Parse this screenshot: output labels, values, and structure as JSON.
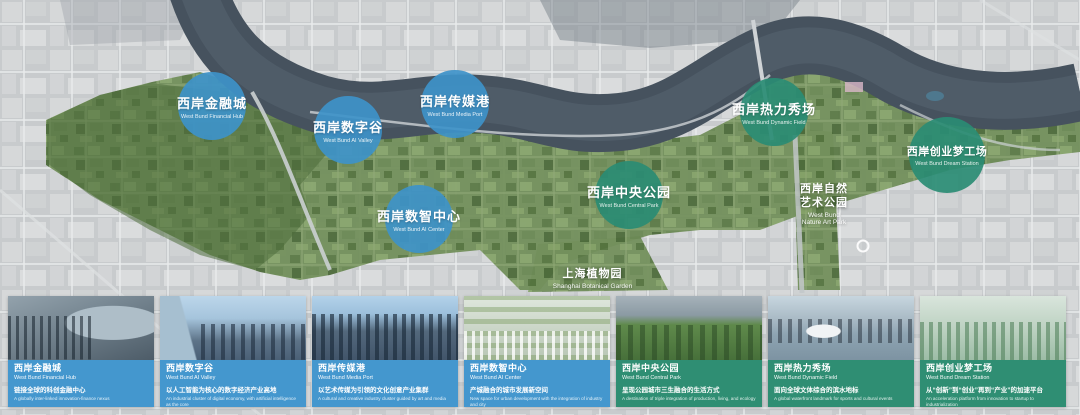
{
  "colors": {
    "zone_blue": "#3e92c9",
    "zone_green": "#2a8c74",
    "panel_blue": "#4497ce",
    "panel_green": "#2f8e73",
    "river": "#46525e",
    "map_grey": "#c6c9cb",
    "green_corridor": "#73905c"
  },
  "map": {
    "zones": [
      {
        "id": "financial-hub",
        "title_zh": "西岸金融城",
        "title_en": "West Bund Financial Hub"
      },
      {
        "id": "digital-valley",
        "title_zh": "西岸数字谷",
        "title_en": "West Bund AI Valley"
      },
      {
        "id": "media-port",
        "title_zh": "西岸传媒港",
        "title_en": "West Bund Media Port"
      },
      {
        "id": "ai-center",
        "title_zh": "西岸数智中心",
        "title_en": "West Bund AI Center"
      },
      {
        "id": "central-park",
        "title_zh": "西岸中央公园",
        "title_en": "West Bund Central Park"
      },
      {
        "id": "dynamic-field",
        "title_zh": "西岸热力秀场",
        "title_en": "West Bund Dynamic Field"
      },
      {
        "id": "dream-station",
        "title_zh": "西岸创业梦工场",
        "title_en": "West Bund Dream Station"
      }
    ],
    "labels": {
      "nature_art_park": {
        "zh1": "西岸自然",
        "zh2": "艺术公园",
        "en1": "West Bund",
        "en2": "Nature Art Park"
      },
      "botanical_garden": {
        "zh": "上海植物园",
        "en": "Shanghai Botanical Garden"
      }
    }
  },
  "cards": [
    {
      "title_zh": "西岸金融城",
      "title_en": "West Bund Financial Hub",
      "desc_zh": "链接全球的科创金融中心",
      "desc_en": "A globally inter-linked innovation-finance nexus"
    },
    {
      "title_zh": "西岸数字谷",
      "title_en": "West Bund AI Valley",
      "desc_zh": "以人工智能为核心的数字经济产业高地",
      "desc_en": "An industrial cluster of digital economy, with artificial intelligence as the core"
    },
    {
      "title_zh": "西岸传媒港",
      "title_en": "West Bund Media Port",
      "desc_zh": "以艺术传媒为引领的文化创意产业集群",
      "desc_en": "A cultural and creative industry cluster guided by art and media"
    },
    {
      "title_zh": "西岸数智中心",
      "title_en": "West Bund AI Center",
      "desc_zh": "产城融合的城市发展新空间",
      "desc_en": "New space for urban development with the integration of industry and city"
    },
    {
      "title_zh": "西岸中央公园",
      "title_en": "West Bund Central Park",
      "desc_zh": "呈现公园城市三生融合的生活方式",
      "desc_en": "A destination of triple integration of production, living, and ecology"
    },
    {
      "title_zh": "西岸热力秀场",
      "title_en": "West Bund Dynamic Field",
      "desc_zh": "面向全球文体综合的滨水地标",
      "desc_en": "A global waterfront landmark for sports and cultural events"
    },
    {
      "title_zh": "西岸创业梦工场",
      "title_en": "West Bund Dream Station",
      "desc_zh": "从“创新”到“创业”再到“产业”的加速平台",
      "desc_en": "An acceleration platform from innovation to startup to industrialization"
    }
  ]
}
